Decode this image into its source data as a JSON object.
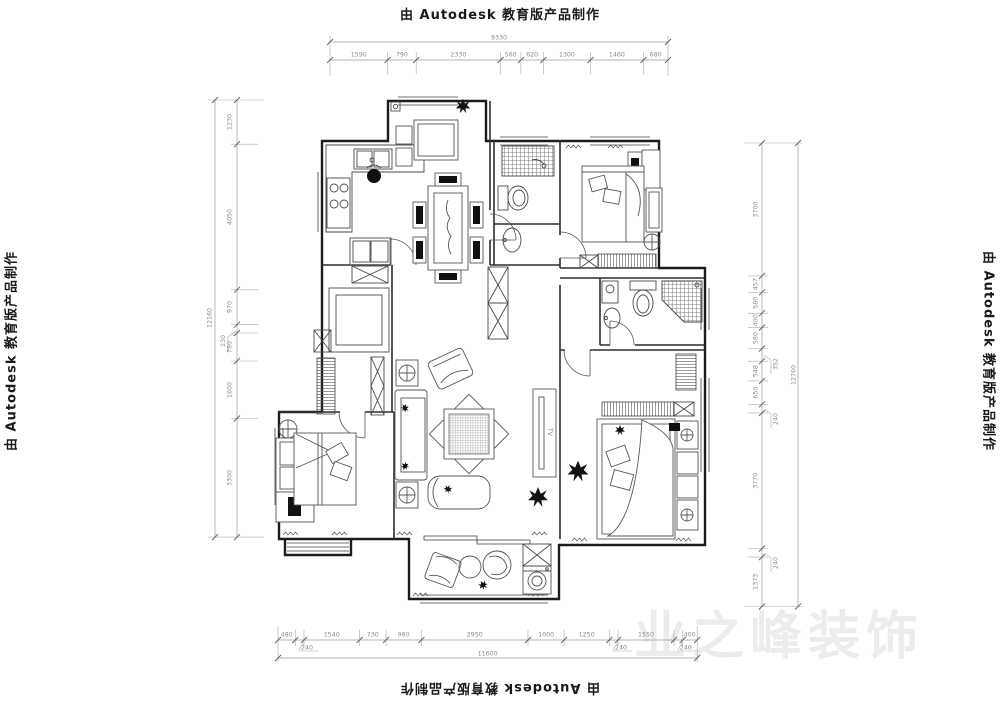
{
  "watermark": {
    "autodesk": "由 Autodesk 教育版产品制作",
    "brand": "业之峰装饰"
  },
  "plan": {
    "tv_label": "TV"
  },
  "dimensions": {
    "top": {
      "total": "9330",
      "segments": [
        "1590",
        "790",
        "2330",
        "560",
        "620",
        "1300",
        "1460",
        "680"
      ]
    },
    "bottom": {
      "total": "11600",
      "segments": [
        "480",
        "1540",
        "730",
        "980",
        "2950",
        "1000",
        "1250",
        "1550",
        "400"
      ],
      "leader_labels": [
        "240",
        "240",
        "240"
      ]
    },
    "left": {
      "total": "12160",
      "segments": [
        "1230",
        "4050",
        "970",
        "780",
        "1600",
        "3300"
      ],
      "leader_labels": [
        "230"
      ]
    },
    "right": {
      "total": "12760",
      "segments": [
        "3700",
        "457",
        "580",
        "400",
        "580",
        "548",
        "650",
        "3770",
        "1373"
      ],
      "leader_labels": [
        "352",
        "240",
        "240"
      ]
    }
  }
}
